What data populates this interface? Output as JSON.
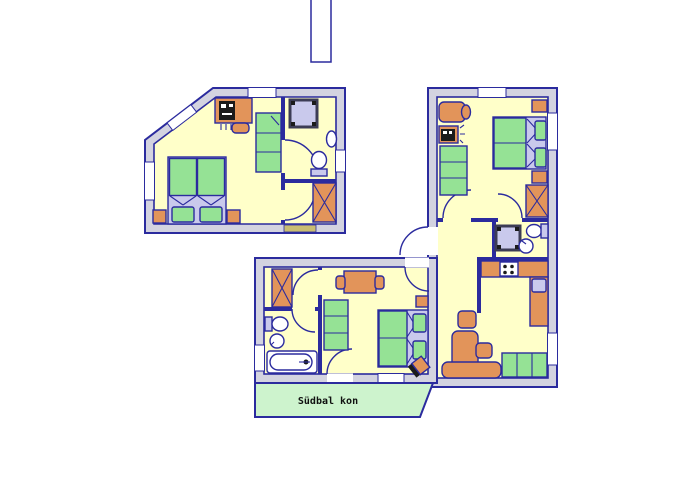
{
  "balcony": {
    "label": "Südbal kon"
  },
  "palette": {
    "background": "#ffffff",
    "wall_fill": "#d3d3e0",
    "wall_stroke": "#2b2b9e",
    "room_fill": "#ffffc9",
    "furniture_orange": "#e2945a",
    "furniture_green": "#95e295",
    "soft_lavender": "#c9c9ec",
    "balcony_green": "#cdf3cd",
    "sill_tan": "#c9bd72",
    "device_black": "#1b1b1b",
    "shower_frame": "#3c3c55"
  },
  "apartments": [
    {
      "id": "left-studio",
      "rooms": [
        "bedroom",
        "bathroom",
        "hall"
      ],
      "furniture": [
        "desk-with-computer",
        "desk-chair",
        "sofa",
        "double-bed",
        "nightstand",
        "nightstand",
        "shower",
        "wash-basin",
        "toilet",
        "wardrobe"
      ]
    },
    {
      "id": "right-apartment",
      "rooms": [
        "bedroom",
        "bathroom",
        "hall",
        "kitchen-living-room"
      ],
      "furniture": [
        "armchair",
        "desk-with-computer",
        "sofa",
        "double-bed",
        "nightstand",
        "nightstand",
        "wardrobe",
        "shower",
        "toilet",
        "wash-basin",
        "kitchen-counter",
        "stove",
        "kitchen-sink",
        "corner-bench",
        "side-table",
        "side-table",
        "sofa"
      ]
    },
    {
      "id": "lower-apartment",
      "rooms": [
        "hall",
        "bathroom",
        "living-bedroom",
        "balcony"
      ],
      "furniture": [
        "wardrobe",
        "toilet",
        "wash-basin",
        "bathtub",
        "dining-table",
        "chair",
        "chair",
        "sofa",
        "double-bed",
        "nightstand",
        "tv"
      ]
    }
  ]
}
